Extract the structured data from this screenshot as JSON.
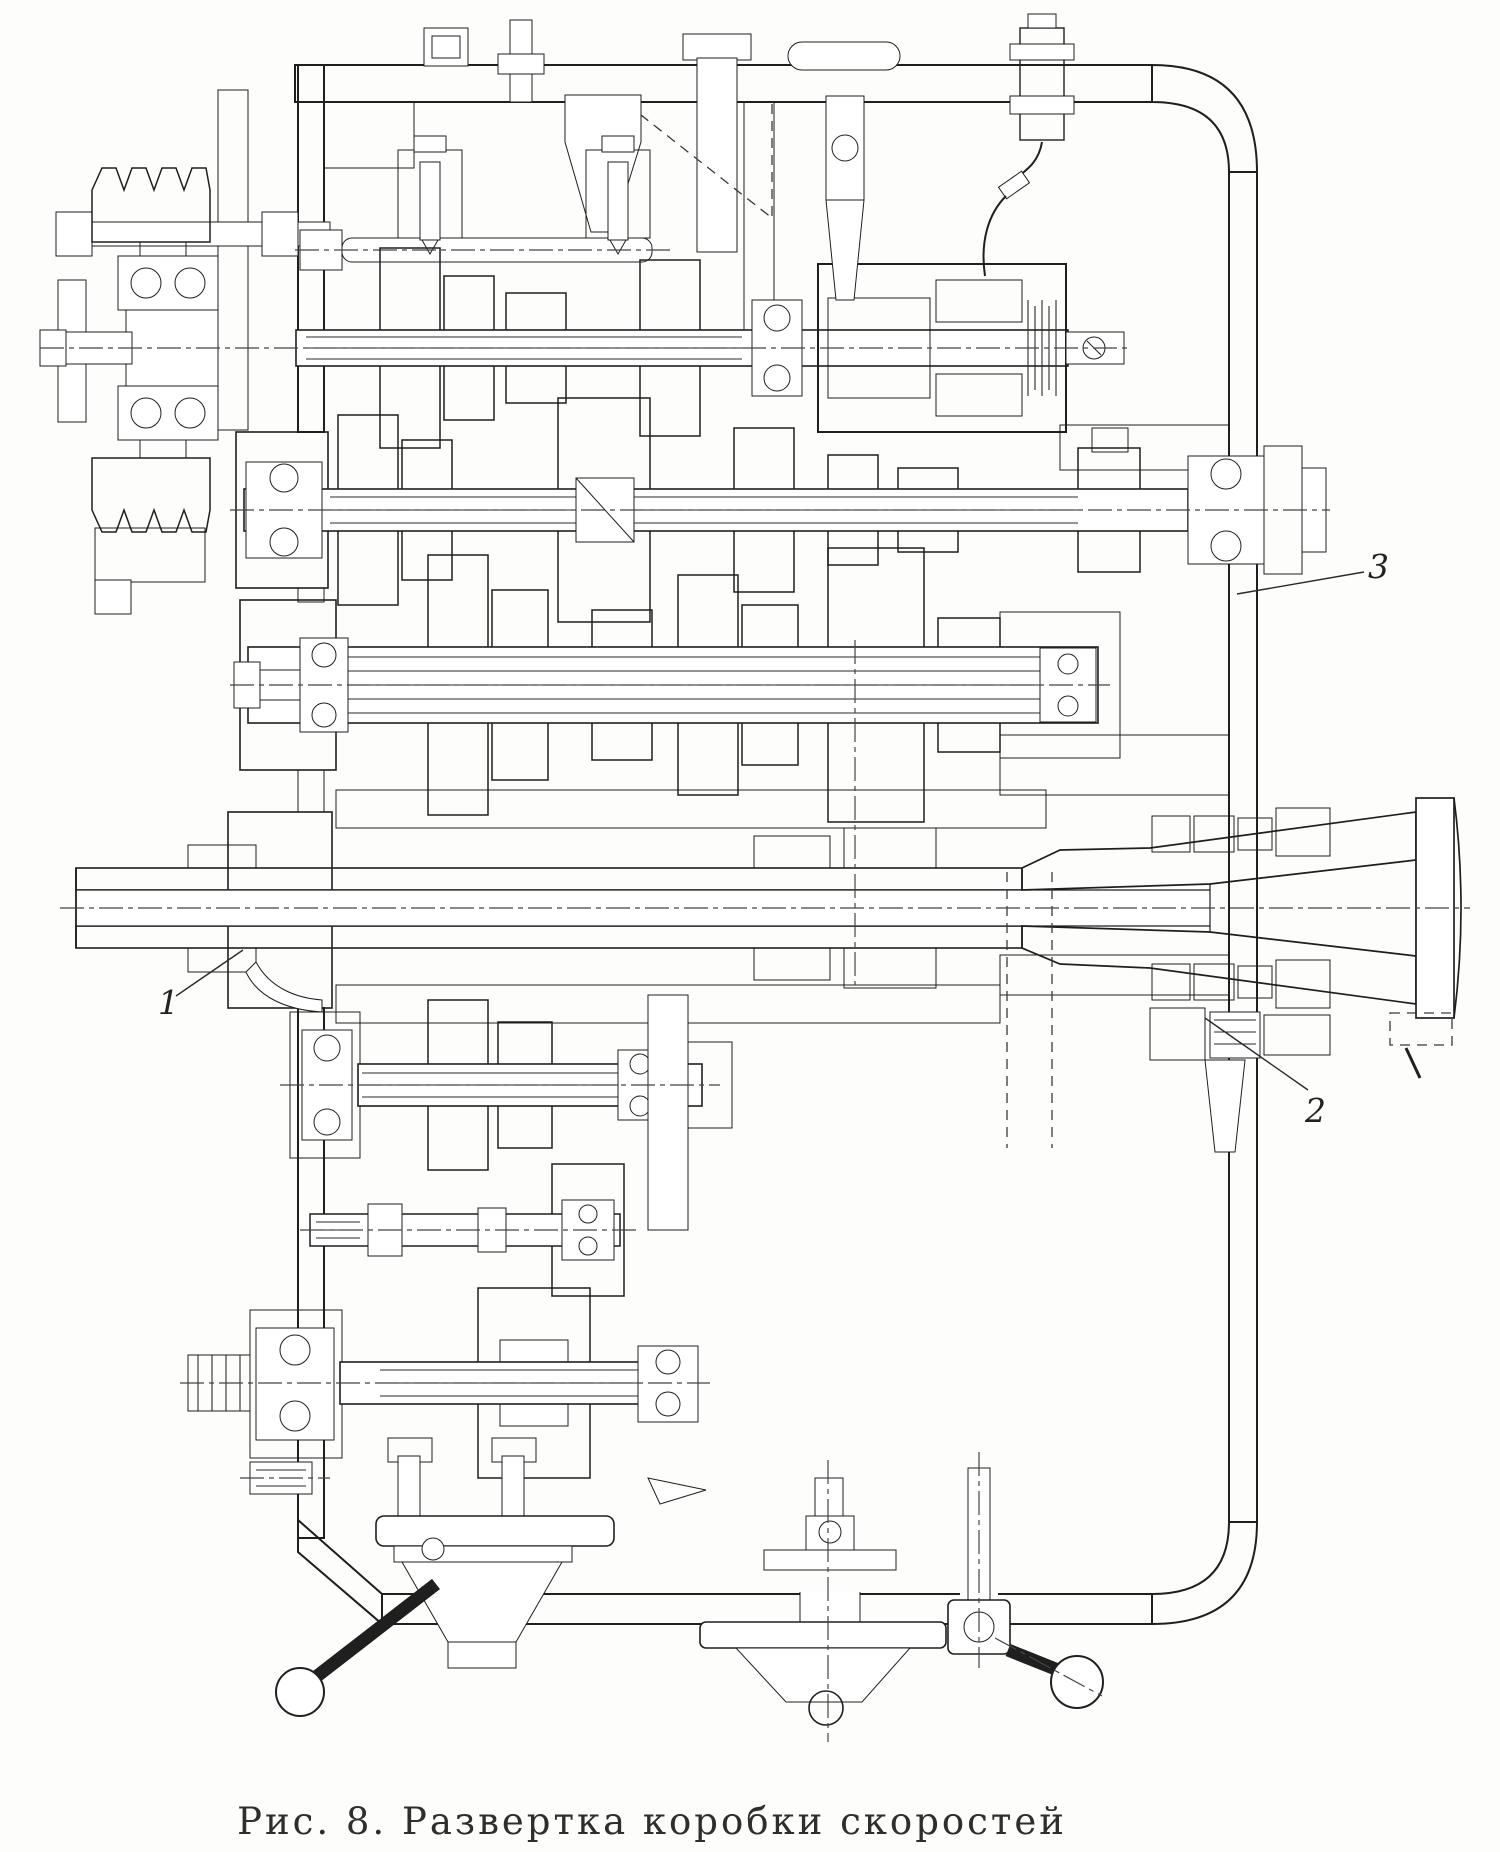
{
  "figure": {
    "caption": "Рис. 8. Развертка коробки скоростей",
    "callouts": {
      "one": "1",
      "two": "2",
      "three": "3"
    }
  },
  "colors": {
    "ink": "#1f1f1f",
    "paper": "#fdfdfc"
  }
}
